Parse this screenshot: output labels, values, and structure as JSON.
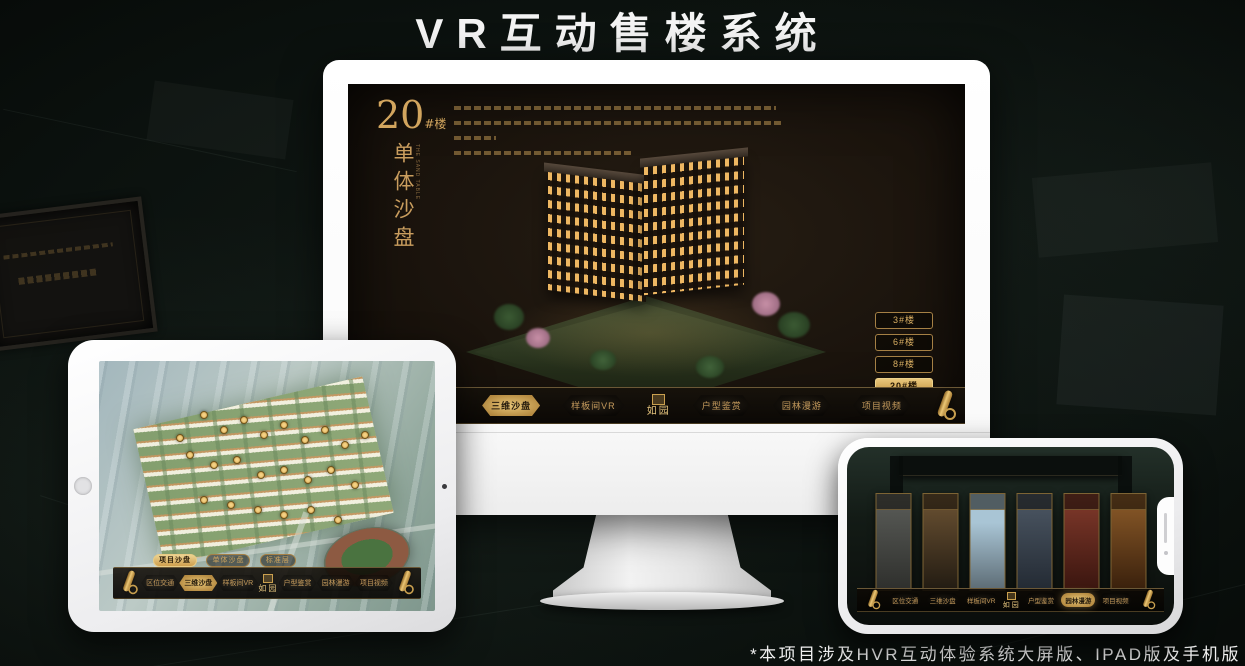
{
  "banner": {
    "title": "VR互动售楼系统"
  },
  "footnote": {
    "text": "*本项目涉及HVR互动体验系统大屏版、IPAD版及手机版"
  },
  "colors": {
    "gold": "#c49a5c",
    "gold_bright": "#e7c577",
    "screen_bg": "#1b140d",
    "page_bg": "#0c1210"
  },
  "monitor": {
    "hero": {
      "number": "20",
      "suffix": "#楼",
      "vertical_title": "单体沙盘"
    },
    "floor_buttons": [
      {
        "label": "3#楼",
        "selected": false
      },
      {
        "label": "6#楼",
        "selected": false
      },
      {
        "label": "8#楼",
        "selected": false
      },
      {
        "label": "20#楼",
        "selected": true
      }
    ],
    "tabs": [
      {
        "label": "项目沙盘",
        "selected": false
      },
      {
        "label": "单体沙盘",
        "selected": true
      },
      {
        "label": "标准层",
        "selected": false
      }
    ],
    "menu": [
      {
        "label": "区位交通",
        "selected": false
      },
      {
        "label": "三维沙盘",
        "selected": true
      },
      {
        "label": "样板间VR",
        "selected": false
      },
      {
        "label": "户型鉴赏",
        "selected": false
      },
      {
        "label": "园林漫游",
        "selected": false
      },
      {
        "label": "项目视频",
        "selected": false
      }
    ],
    "logo_text": "如园"
  },
  "tablet": {
    "tabs": [
      {
        "label": "项目沙盘",
        "selected": true
      },
      {
        "label": "单体沙盘",
        "selected": false
      },
      {
        "label": "标准层",
        "selected": false
      }
    ],
    "menu": [
      {
        "label": "区位交通",
        "selected": false
      },
      {
        "label": "三维沙盘",
        "selected": true
      },
      {
        "label": "样板间VR",
        "selected": false
      },
      {
        "label": "户型鉴赏",
        "selected": false
      },
      {
        "label": "园林漫游",
        "selected": false
      },
      {
        "label": "项目视频",
        "selected": false
      }
    ],
    "logo_text": "如园"
  },
  "phone": {
    "menu": [
      {
        "label": "区位交通",
        "selected": false
      },
      {
        "label": "三维沙盘",
        "selected": false
      },
      {
        "label": "样板间VR",
        "selected": false
      },
      {
        "label": "户型鉴赏",
        "selected": false
      },
      {
        "label": "园林漫游",
        "selected": true
      },
      {
        "label": "项目视频",
        "selected": false
      }
    ],
    "logo_text": "如园"
  }
}
